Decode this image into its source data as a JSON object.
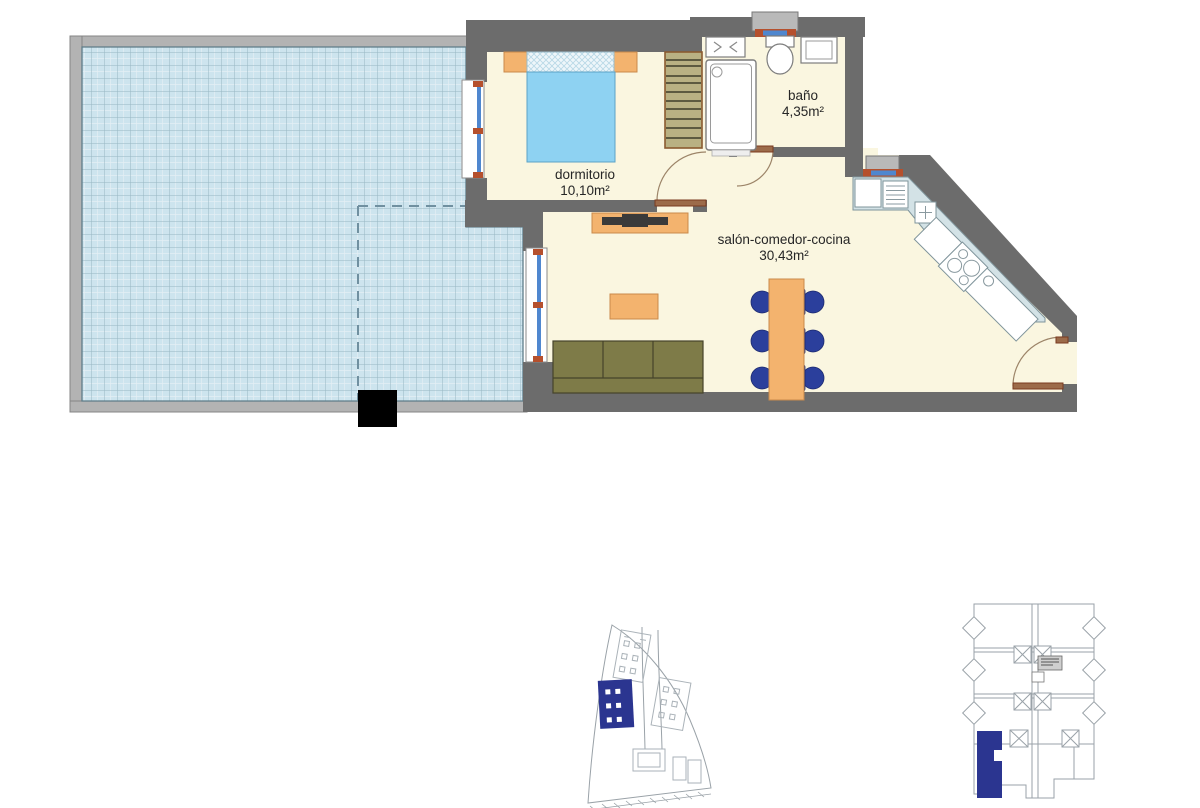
{
  "plan": {
    "type": "apartment floor plan",
    "rooms": {
      "dormitorio": {
        "label": "dormitorio",
        "area": "10,10m²"
      },
      "bano": {
        "label": "baño",
        "area": "4,35m²"
      },
      "salon": {
        "label": "salón-comedor-cocina",
        "area": "30,43m²"
      }
    }
  },
  "colors": {
    "wall_dark": "#6c6c6c",
    "wall_light": "#b3b3b3",
    "floor_cream": "#faf6e0",
    "tile_fill": "#cde4ee",
    "tile_line": "#97b6c3",
    "furniture_orange": "#f3b36e",
    "frame_red": "#b5502d",
    "glass_blue": "#4f87cf",
    "mattress_blue": "#8ed2f2",
    "sofa_olive": "#7e7b48",
    "wardrobe_tan": "#b9b183",
    "chair_navy": "#2b3f9c",
    "counter_blue": "#d3e2e6",
    "site_navy": "#2b3590",
    "outline_gray": "#9aa2a8",
    "text": "#262626"
  }
}
